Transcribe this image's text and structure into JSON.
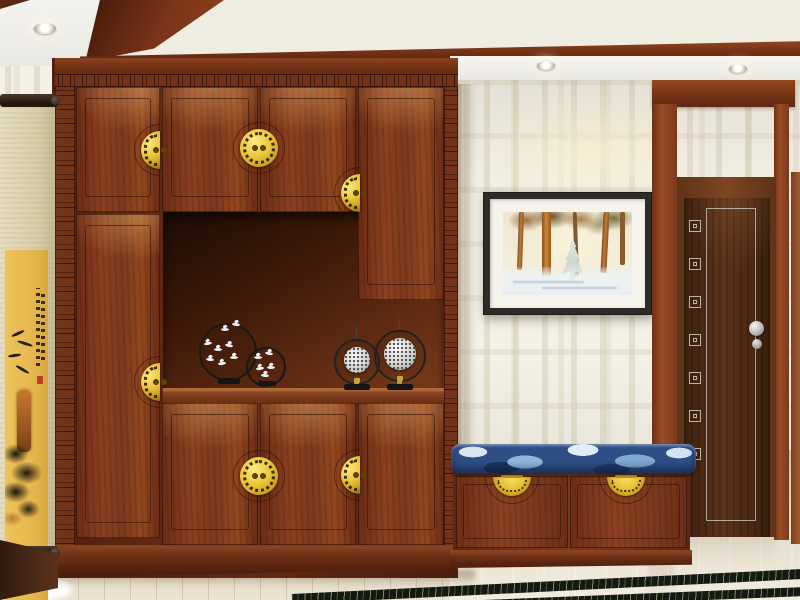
{
  "scene": {
    "type": "interior-photo-render",
    "description": "New-Chinese-style entry hallway: red-brown wooden hallway cabinet with gold medallion pulls and display niche, hanging ink scroll painting, fret-pattern wallpaper, framed winter-forest watercolor, dark walnut interior door, storage bench with blue cloud-pattern cushion, light stone floor with dark marble inlay border",
    "text_visible": "none"
  },
  "palette": {
    "cabinet_wood": "#82391e",
    "cabinet_dark": "#4a1d0d",
    "niche_shadow": "#1e0c04",
    "gold_hardware": "#e7c335",
    "ceiling_cream": "#f7ecc3",
    "ceiling_wood_band": "#6e2f17",
    "soffit_white": "#f4f3ef",
    "wallpaper_base": "#f3f0e6",
    "wallpaper_pattern": "#d6d0b8",
    "door_slab": "#4a2814",
    "door_casing": "#8a4526",
    "door_inline_silver": "#d7d2c6",
    "cushion_navy": "#2e4f86",
    "cushion_light_blue": "#8fb8da",
    "cushion_white": "#d9e6f2",
    "floor_light": "#e6dfcd",
    "marble_inlay_dark": "#141a10",
    "scroll_cloth": "#ded4b6",
    "scroll_panel_gold": "#e7b84e",
    "seal_red": "#c03a2a",
    "picture_frame": "#2e2c29",
    "picture_mat": "#f5f3ec"
  },
  "objects": {
    "ceiling": {
      "recessed_spotlights": 3,
      "tray_band_material": "red-brown wood",
      "panel": "warm cream with cove glow"
    },
    "cabinet": {
      "doors_upper": 4,
      "doors_lower": 4,
      "tall_wardrobe_doors": 2,
      "open_niche": true,
      "fret_carved_top_band": true,
      "fret_side_stiles": 2,
      "handles": "round pierced gold medallions with twin ring pulls, split across door pairs"
    },
    "niche_ornaments": [
      {
        "name": "black-ring-with-cranes-large",
        "cranes": 8
      },
      {
        "name": "black-ring-with-cranes-small",
        "cranes": 5
      },
      {
        "name": "silver-lace-medallion-ring-small",
        "tassel": "gold"
      },
      {
        "name": "silver-lace-medallion-ring-large",
        "tassel": "gold"
      }
    ],
    "bench": {
      "cushion": "navy blue cloud pattern",
      "drawers": 2,
      "drawer_handles": "gold half-moon fan pulls"
    },
    "wall_art": {
      "framed_picture": "winter pine forest watercolor, black frame, white mat",
      "scroll": "gold-ground ink painting with calligraphy column and red seal"
    },
    "door": {
      "style": "dark walnut, silver inline, vertical column of silver fret squares",
      "knob": "round stainless with lock rosette"
    },
    "floor": {
      "left": "light plank tile",
      "right": "polished light stone with warm under-door glow",
      "inlay": "two dark green marble border strips"
    }
  }
}
